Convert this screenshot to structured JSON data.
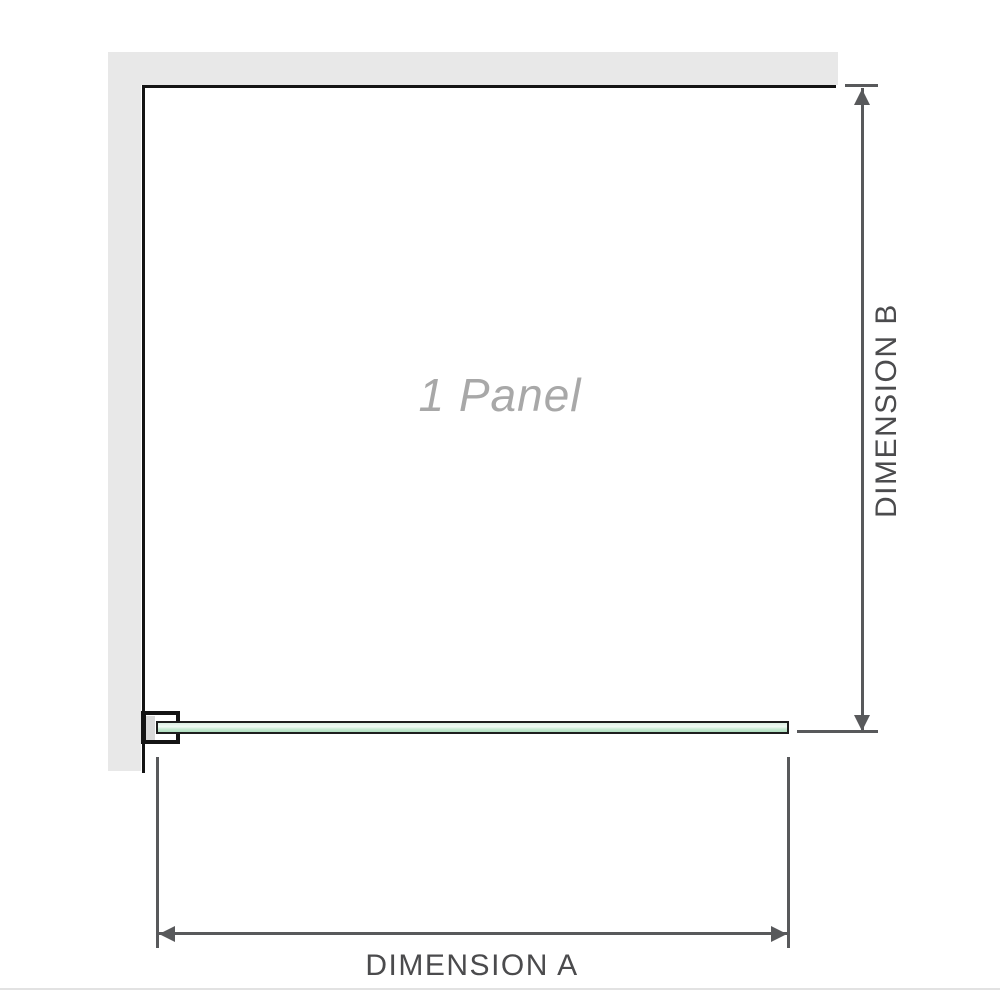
{
  "diagram": {
    "panel_label": "1 Panel",
    "dimension_a_label": "DIMENSION A",
    "dimension_b_label": "DIMENSION B"
  },
  "colors": {
    "wall_gray": "#e8e8e8",
    "outline_black": "#141414",
    "dimension_line_gray": "#58595b",
    "dimension_text_gray": "#4b4b4d",
    "panel_text_gray": "#a8a8a8",
    "glass_green_light": "#dcf0e2",
    "glass_green_mid": "#c6e9d1",
    "glass_green_deep": "#b0dfc0",
    "glass_border": "#1e1e1e",
    "bracket_pad_gray": "#d9d9d9"
  }
}
